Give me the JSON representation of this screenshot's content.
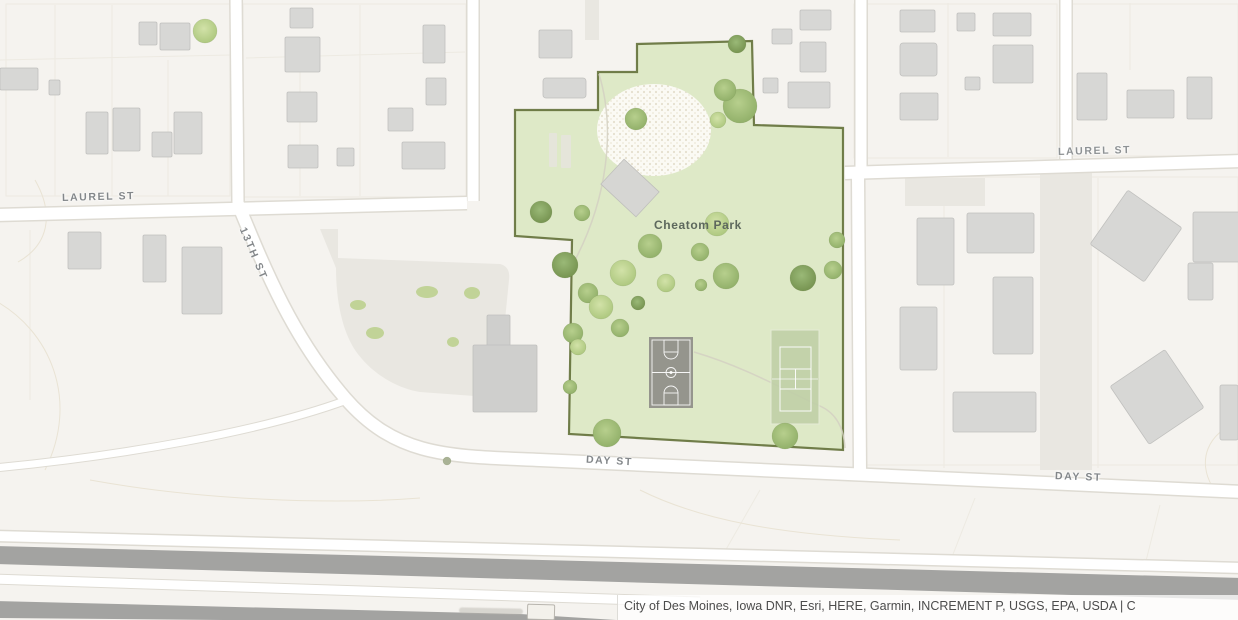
{
  "map": {
    "park": {
      "name": "Cheatom Park"
    },
    "street_labels": {
      "laurel_st_left": "LAUREL ST",
      "laurel_st_right": "LAUREL ST",
      "thirteenth_st": "13TH ST",
      "day_st_left": "DAY ST",
      "day_st_right": "DAY ST"
    },
    "attribution": {
      "text": "City of Des Moines, Iowa DNR, Esri, HERE, Garmin, INCREMENT P, USGS, EPA, USDA | C"
    },
    "colors": {
      "background": "#f5f3ef",
      "park_fill": "#dbe7bf",
      "park_outline": "#5a682f",
      "building": "#d7d7d5",
      "road": "#ffffff",
      "road_casing": "#dedbd3",
      "corridor_band": "#a3a3a1",
      "tree_green": "#9ab569",
      "court_gray": "#95958d",
      "tennis_green": "#bfcfa6",
      "street_label": "#83878a",
      "park_label": "#5d685d",
      "attribution_text": "#4c4c4c",
      "attribution_bg": "rgba(255,255,255,0.75)"
    }
  }
}
